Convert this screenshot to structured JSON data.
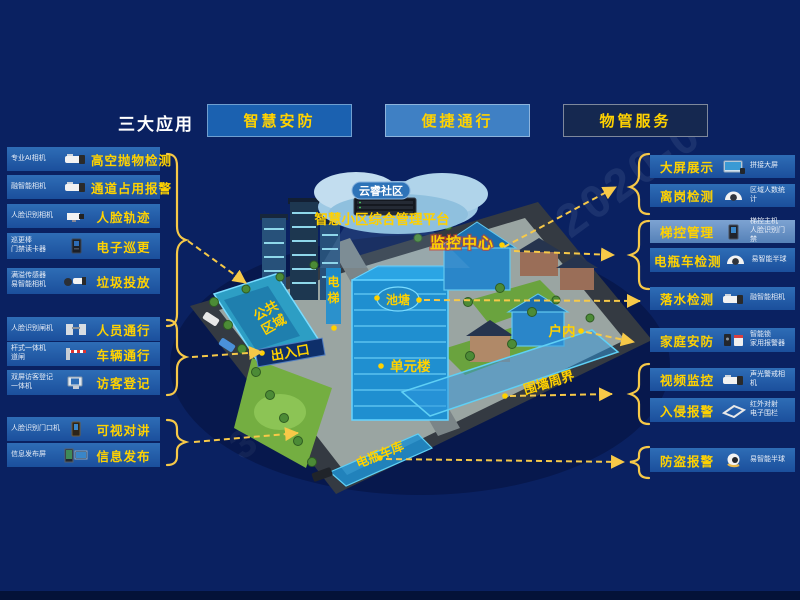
{
  "header": {
    "title": "三大应用",
    "buttons": [
      {
        "label": "智慧安防"
      },
      {
        "label": "便捷通行"
      },
      {
        "label": "物管服务"
      }
    ]
  },
  "left_items": [
    {
      "device": "专业AI相机",
      "label": "高空抛物检测",
      "icon": "bullet-camera"
    },
    {
      "device": "融智能相机",
      "label": "通道占用报警",
      "icon": "bullet-camera"
    },
    {
      "device": "人脸识别相机",
      "label": "人脸轨迹",
      "icon": "box-camera"
    },
    {
      "device": "巡更棒\n门禁读卡器",
      "label": "电子巡更",
      "icon": "card-reader"
    },
    {
      "device": "满溢传感器\n易智能相机",
      "label": "垃圾投放",
      "icon": "sensor-bullet-camera"
    },
    {
      "device": "人脸识别闸机",
      "label": "人员通行",
      "icon": "turnstile"
    },
    {
      "device": "杆式一体机\n道闸",
      "label": "车辆通行",
      "icon": "barrier-gate"
    },
    {
      "device": "双屏访客登记\n一体机",
      "label": "访客登记",
      "icon": "visitor-terminal"
    },
    {
      "device": "人脸识别门口机",
      "label": "可视对讲",
      "icon": "door-station"
    },
    {
      "device": "信息发布屏",
      "label": "信息发布",
      "icon": "info-screen"
    }
  ],
  "right_items": [
    {
      "label": "大屏展示",
      "device": "拼接大屏",
      "icon": "video-wall"
    },
    {
      "label": "离岗检测",
      "device": "区域人数统计",
      "icon": "dome-camera"
    },
    {
      "label": "梯控管理",
      "device": "梯控主机\n人脸识别门禁",
      "icon": "access-panel"
    },
    {
      "label": "电瓶车检测",
      "device": "易智能半球",
      "icon": "dome-camera"
    },
    {
      "label": "落水检测",
      "device": "融智能相机",
      "icon": "bullet-camera"
    },
    {
      "label": "家庭安防",
      "device": "智能锁\n家用报警器",
      "icon": "lock-alarm"
    },
    {
      "label": "视频监控",
      "device": "声光警戒相机",
      "icon": "bullet-camera"
    },
    {
      "label": "入侵报警",
      "device": "红外对射\n电子围栏",
      "icon": "fence"
    },
    {
      "label": "防盗报警",
      "device": "易智能半球",
      "icon": "turret-camera"
    }
  ],
  "map": {
    "cloud_label": "云睿社区",
    "platform_label": "智慧小区综合管理平台",
    "zones": {
      "monitor_center": "监控中心",
      "elevator_1": "电",
      "elevator_2": "梯",
      "pond": "池塘",
      "public_area_1": "公共",
      "public_area_2": "区域",
      "entrance": "出入口",
      "unit_building": "单元楼",
      "indoor": "户内",
      "perimeter": "围墙周界",
      "bike_garage": "电瓶车库"
    }
  },
  "watermarks": {
    "top_right": "2020-0",
    "bottom_left": "33-"
  },
  "colors": {
    "background": "#0a2161",
    "accent_yellow": "#ffd200",
    "arrow_yellow": "#f7c948",
    "bar_blue": "#1b4f9c",
    "bar_light_blue": "#5581b8",
    "highlight_blue": "#1f8fd0",
    "button_security": "#1b61b0",
    "button_access": "#3f80c4",
    "button_property": "#152850"
  }
}
